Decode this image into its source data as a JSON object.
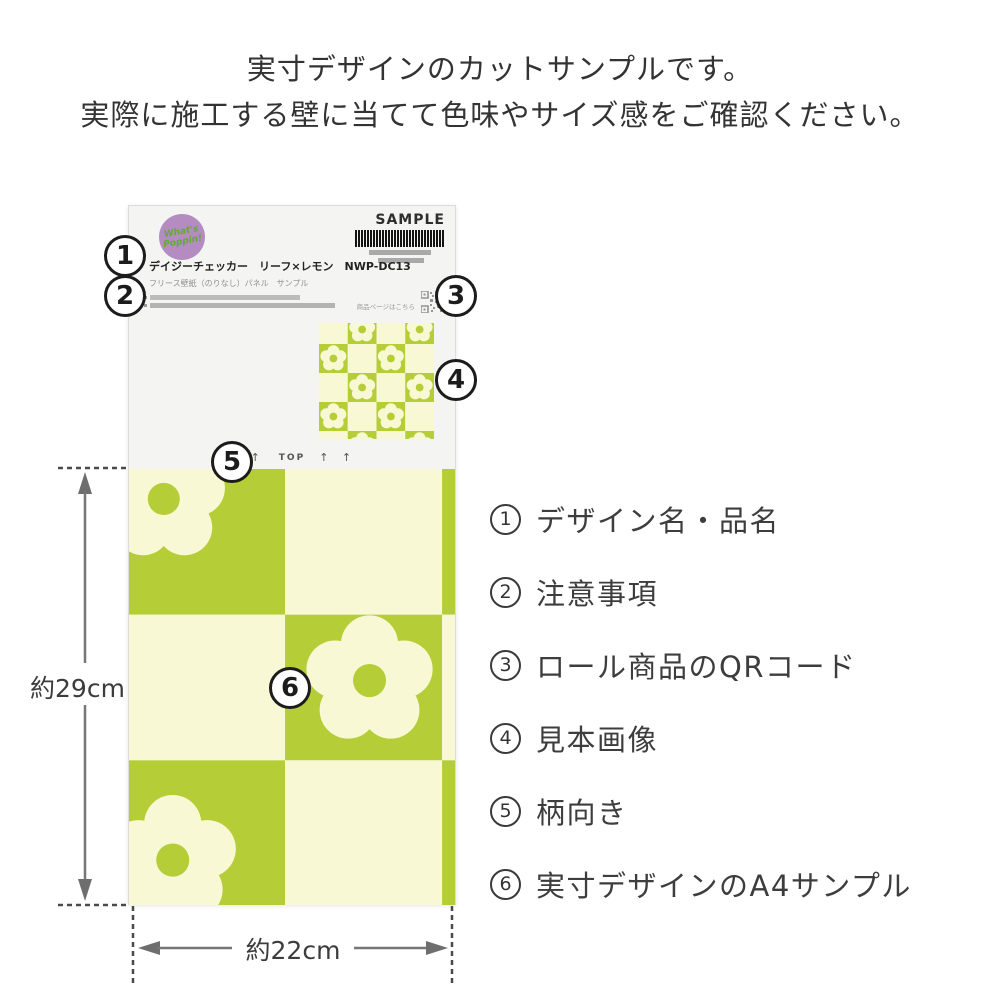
{
  "intro": {
    "line1": "実寸デザインのカットサンプルです。",
    "line2": "実際に施工する壁に当てて色味やサイズ感をご確認ください。"
  },
  "sheet": {
    "sample_label": "SAMPLE",
    "logo": {
      "line1": "What's",
      "line2": "Poppin!"
    },
    "product_name": "デイジーチェッカー　リーフ×レモン　NWP-DC13",
    "product_subtitle": "フリース壁紙（のりなし）パネル　サンプル",
    "qr_caption": "商品ページはこちら",
    "top_marking": {
      "arrows_left": "↑ ↑",
      "label": "TOP",
      "arrows_right": "↑ ↑"
    }
  },
  "callouts": [
    "1",
    "2",
    "3",
    "4",
    "5",
    "6"
  ],
  "dimensions": {
    "height_label": "約29cm",
    "width_label": "約22cm"
  },
  "legend": {
    "items": [
      {
        "num": "1",
        "label": "デザイン名・品名"
      },
      {
        "num": "2",
        "label": "注意事項"
      },
      {
        "num": "3",
        "label": "ロール商品のQRコード"
      },
      {
        "num": "4",
        "label": "見本画像"
      },
      {
        "num": "5",
        "label": "柄向き"
      },
      {
        "num": "6",
        "label": "実寸デザインのA4サンプル"
      }
    ]
  },
  "colors": {
    "pattern_green": "#b5cd37",
    "pattern_cream": "#f9f8d4",
    "logo_purple": "#b48cc2",
    "logo_green": "#5fae2a"
  }
}
